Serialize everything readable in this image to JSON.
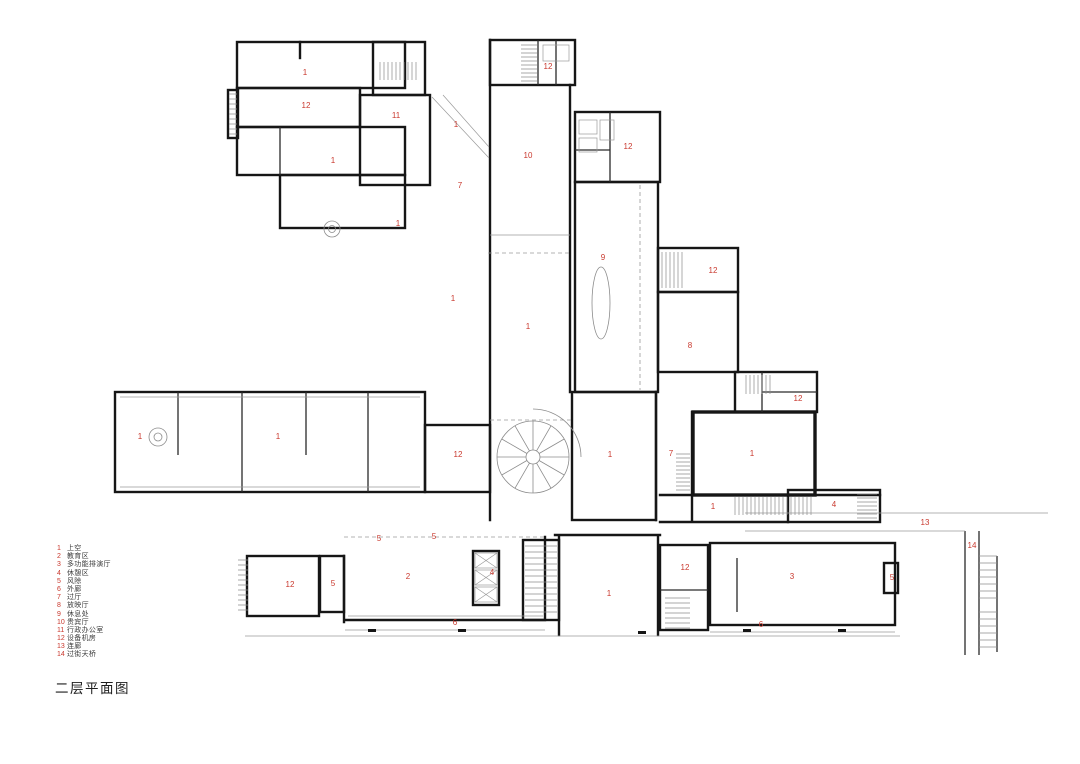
{
  "title": "二层平面图",
  "colors": {
    "label_red": "#c9392e",
    "wall_black": "#161616",
    "detail_gray": "#999999"
  },
  "legend": {
    "items": [
      {
        "num": "1",
        "label": "上空"
      },
      {
        "num": "2",
        "label": "教育区"
      },
      {
        "num": "3",
        "label": "多功能排演厅"
      },
      {
        "num": "4",
        "label": "休憩区"
      },
      {
        "num": "5",
        "label": "风除"
      },
      {
        "num": "6",
        "label": "外廊"
      },
      {
        "num": "7",
        "label": "过厅"
      },
      {
        "num": "8",
        "label": "放映厅"
      },
      {
        "num": "9",
        "label": "休息处"
      },
      {
        "num": "10",
        "label": "贵宾厅"
      },
      {
        "num": "11",
        "label": "行政办公室"
      },
      {
        "num": "12",
        "label": "设备机房"
      },
      {
        "num": "13",
        "label": "连廊"
      },
      {
        "num": "14",
        "label": "过街天桥"
      }
    ]
  },
  "plan": {
    "room_labels": [
      {
        "num": "1",
        "x": 305,
        "y": 73
      },
      {
        "num": "12",
        "x": 548,
        "y": 67
      },
      {
        "num": "12",
        "x": 306,
        "y": 106
      },
      {
        "num": "11",
        "x": 396,
        "y": 116
      },
      {
        "num": "1",
        "x": 456,
        "y": 125
      },
      {
        "num": "12",
        "x": 628,
        "y": 147
      },
      {
        "num": "1",
        "x": 333,
        "y": 161
      },
      {
        "num": "10",
        "x": 528,
        "y": 156
      },
      {
        "num": "7",
        "x": 460,
        "y": 186
      },
      {
        "num": "1",
        "x": 398,
        "y": 224
      },
      {
        "num": "9",
        "x": 603,
        "y": 258
      },
      {
        "num": "12",
        "x": 713,
        "y": 271
      },
      {
        "num": "1",
        "x": 453,
        "y": 299
      },
      {
        "num": "1",
        "x": 528,
        "y": 327
      },
      {
        "num": "8",
        "x": 690,
        "y": 346
      },
      {
        "num": "12",
        "x": 798,
        "y": 399
      },
      {
        "num": "1",
        "x": 140,
        "y": 437
      },
      {
        "num": "1",
        "x": 278,
        "y": 437
      },
      {
        "num": "12",
        "x": 458,
        "y": 455
      },
      {
        "num": "1",
        "x": 610,
        "y": 455
      },
      {
        "num": "7",
        "x": 671,
        "y": 454
      },
      {
        "num": "1",
        "x": 752,
        "y": 454
      },
      {
        "num": "1",
        "x": 713,
        "y": 507
      },
      {
        "num": "4",
        "x": 834,
        "y": 505
      },
      {
        "num": "13",
        "x": 925,
        "y": 523
      },
      {
        "num": "14",
        "x": 972,
        "y": 546
      },
      {
        "num": "5",
        "x": 379,
        "y": 539
      },
      {
        "num": "5",
        "x": 434,
        "y": 537
      },
      {
        "num": "12",
        "x": 290,
        "y": 585
      },
      {
        "num": "5",
        "x": 333,
        "y": 584
      },
      {
        "num": "2",
        "x": 408,
        "y": 577
      },
      {
        "num": "4",
        "x": 492,
        "y": 573
      },
      {
        "num": "6",
        "x": 455,
        "y": 623
      },
      {
        "num": "1",
        "x": 609,
        "y": 594
      },
      {
        "num": "12",
        "x": 685,
        "y": 568
      },
      {
        "num": "3",
        "x": 792,
        "y": 577
      },
      {
        "num": "5",
        "x": 892,
        "y": 578
      },
      {
        "num": "6",
        "x": 761,
        "y": 625
      }
    ]
  }
}
